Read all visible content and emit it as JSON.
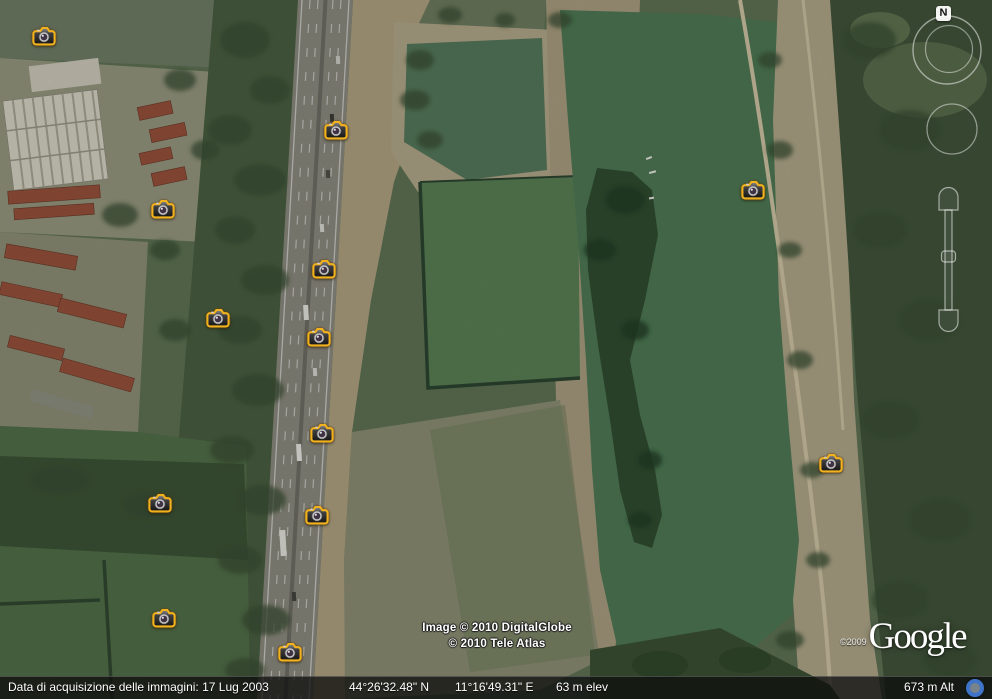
{
  "navigation": {
    "north_label": "N"
  },
  "photo_markers": {
    "icon": "camera-icon",
    "positions": [
      {
        "x": 44,
        "y": 37
      },
      {
        "x": 336,
        "y": 131
      },
      {
        "x": 163,
        "y": 210
      },
      {
        "x": 753,
        "y": 191
      },
      {
        "x": 324,
        "y": 270
      },
      {
        "x": 218,
        "y": 319
      },
      {
        "x": 319,
        "y": 338
      },
      {
        "x": 322,
        "y": 434
      },
      {
        "x": 831,
        "y": 464
      },
      {
        "x": 160,
        "y": 504
      },
      {
        "x": 317,
        "y": 516
      },
      {
        "x": 164,
        "y": 619
      },
      {
        "x": 290,
        "y": 653
      }
    ]
  },
  "attribution": {
    "image_credit": "Image © 2010 DigitalGlobe",
    "map_credit": "© 2010 Tele Atlas",
    "logo_copyright": "©2009",
    "logo_text": "Google"
  },
  "status_bar": {
    "imagery_date": "Data di acquisizione delle immagini: 17 Lug 2003",
    "latitude": "44°26'32.48\" N",
    "longitude": "11°16'49.31\" E",
    "elevation": "63 m elev",
    "altitude": "673 m Alt"
  },
  "colors": {
    "marker_outline": "#f2b21d",
    "streaming_indicator": "#3f74c9",
    "status_bar_bg": "rgba(12,12,12,0.75)"
  }
}
